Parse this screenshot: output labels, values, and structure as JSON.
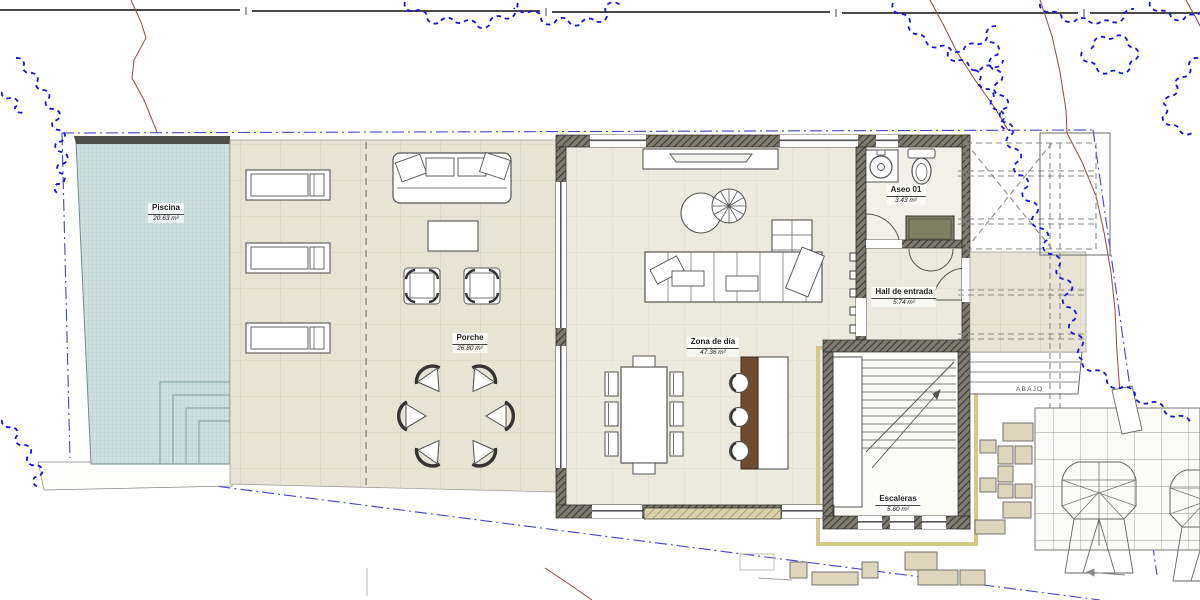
{
  "rooms": [
    {
      "key": "piscina",
      "name": "Piscina",
      "area": "20.63 m²"
    },
    {
      "key": "porche",
      "name": "Porche",
      "area": "26.80 m²"
    },
    {
      "key": "zona-de-dia",
      "name": "Zona de día",
      "area": "47.36 m²"
    },
    {
      "key": "aseo-01",
      "name": "Aseo 01",
      "area": "3.43 m²"
    },
    {
      "key": "hall",
      "name": "Hall de entrada",
      "area": "5.74 m²"
    },
    {
      "key": "escaleras",
      "name": "Escaleras",
      "area": "5.60 m²"
    }
  ],
  "annotations": {
    "abajo": "ABAJO"
  },
  "colors": {
    "pool_water": "#cfe0df",
    "paving": "#e8e4d5",
    "interior_floor": "#eceade",
    "wall": "#77746a",
    "island_wood": "#6e4c33",
    "vegetation_line": "#1414dd",
    "boundary_line": "#4444cc",
    "contour_line": "#8f4a45"
  }
}
